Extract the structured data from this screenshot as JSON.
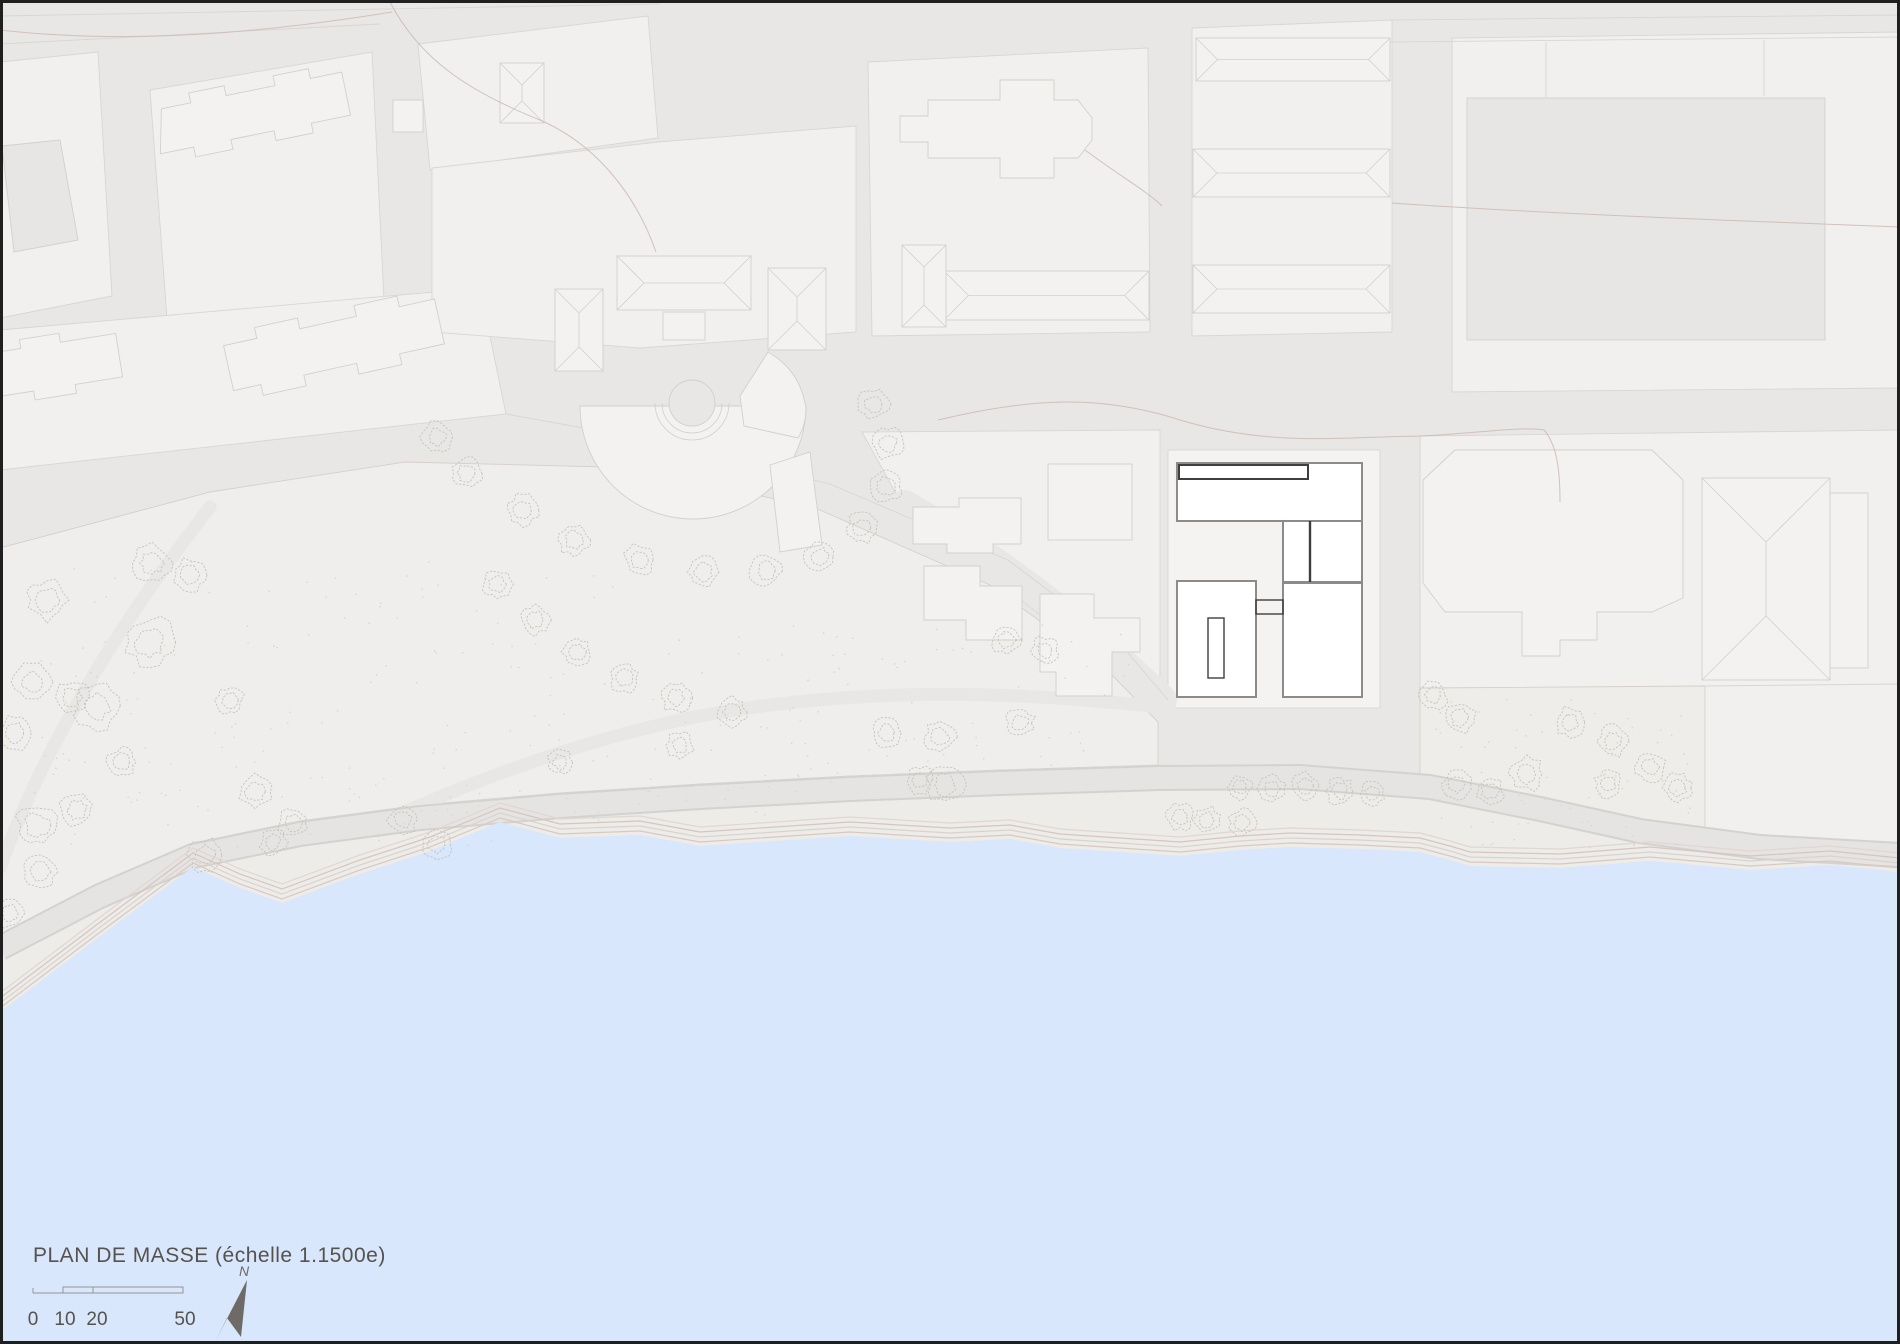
{
  "map": {
    "title": "PLAN DE MASSE (échelle 1.1500e)",
    "north_label": "N",
    "scale_bar": {
      "labels": [
        "0",
        "10",
        "20",
        "50"
      ]
    },
    "colors": {
      "background": "#e8e7e5",
      "parcel": "#f1f0ee",
      "site_parcel": "#f4f3f2",
      "parcel_outline": "#d8d6d3",
      "building": "#f3f2f0",
      "building_dark": "#e7e6e4",
      "building_outline": "#d2d0cd",
      "park": "#efeeec",
      "sand": "#eeede9",
      "park_outline": "#d6cfc9",
      "water": "#d8e7fb",
      "beach": "#edece9",
      "beach_line": "#d9c8c2",
      "esplanade": "#e5e4e2",
      "esplanade_edge": "#d4d2cf",
      "tree": "#c8c2bc",
      "stipple": "#d9d4ce",
      "contour": "#ccb8b3",
      "project_fill": "#ffffff",
      "project_outline": "#3f3e3d",
      "project_outline_mid": "#8d8b89",
      "text": "#56524e",
      "north_arrow": "#6e6a67",
      "scalebar": "#98948f",
      "frame": "#1f1f1f"
    }
  }
}
